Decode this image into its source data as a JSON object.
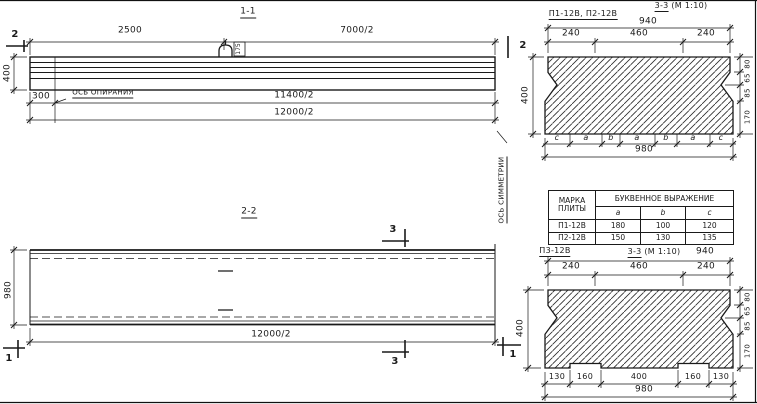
{
  "drawing": {
    "view_1_1": {
      "title": "1-1",
      "dim_top_left": "2500",
      "dim_top_right": "7000/2",
      "dim_height": "400",
      "dim_support": "300",
      "support_axis_label": "ОСЬ ОПИРАНИЯ",
      "dim_half_inner": "11400/2",
      "dim_half_outer": "12000/2",
      "section_mark": "2",
      "loop_label": "175"
    },
    "view_2_2": {
      "title": "2-2",
      "dim_width": "980",
      "dim_half": "12000/2",
      "mark_3": "3",
      "mark_1": "1",
      "symmetry_axis_label": "ОСЬ СИММЕТРИИ"
    },
    "section_top": {
      "plates_label": "П1-12В, П2-12В",
      "title": "3-3",
      "scale": "(М 1:10)",
      "dim_total_top": "940",
      "dims_top": [
        "240",
        "460",
        "240"
      ],
      "dim_height": "400",
      "dims_right": [
        "80",
        "65",
        "85",
        "170"
      ],
      "letters": [
        "c",
        "a",
        "b",
        "a",
        "b",
        "a",
        "c"
      ],
      "dim_total_bottom": "980"
    },
    "table": {
      "col1_header": "МАРКА ПЛИТЫ",
      "group_header": "БУКВЕННОЕ ВЫРАЖЕНИЕ",
      "letter_cols": [
        "a",
        "b",
        "c"
      ],
      "rows": [
        {
          "mark": "П1-12В",
          "a": "180",
          "b": "100",
          "c": "120"
        },
        {
          "mark": "П2-12В",
          "a": "150",
          "b": "130",
          "c": "135"
        }
      ]
    },
    "section_bottom": {
      "plate_label": "П3-12В",
      "title": "3-3",
      "scale": "(М 1:10)",
      "dim_total_top": "940",
      "dims_top": [
        "240",
        "460",
        "240"
      ],
      "dim_height": "400",
      "dims_right": [
        "80",
        "65",
        "85",
        "170"
      ],
      "dims_bottom": [
        "130",
        "160",
        "400",
        "160",
        "130"
      ],
      "dim_total_bottom": "980"
    }
  }
}
